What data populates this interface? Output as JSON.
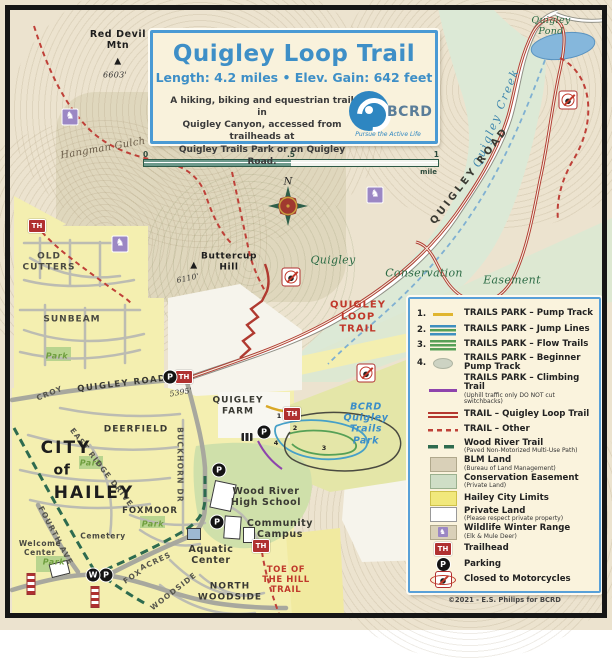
{
  "title_box": {
    "title": "Quigley Loop Trail",
    "stats": "Length: 4.2 miles  •  Elev. Gain: 642 feet",
    "description": "A hiking, biking and equestrian trail in\nQuigley Canyon, accessed from trailheads at\nQuigley Trails Park or on Quigley Road.",
    "logo": {
      "name": "BCRD",
      "tagline": "Pursue the Active Life"
    }
  },
  "scale_bar": {
    "tick0": "0",
    "tick_half": ".5",
    "tick1": "1",
    "unit": "mile"
  },
  "compass": {
    "north": "N"
  },
  "labels": {
    "red_devil_mtn": "Red Devil\nMtn",
    "red_devil_elev": "6603'",
    "triangle": "▲",
    "quigley_pond": "Quigley\nPond",
    "quigley_creek": "Quigley Creek",
    "hangman_gulch": "Hangman Gulch",
    "quigley_road": "QUIGLEY ROAD",
    "old_cutters": "OLD\nCUTTERS",
    "sunbeam": "SUNBEAM",
    "park": "Park",
    "buttercup_hill": "Buttercup\nHill",
    "buttercup_elev": "6110'",
    "cons_quigley": "Quigley",
    "cons_conservation": "Conservation",
    "cons_easement": "Easement",
    "quigley_loop_trail": "QUIGLEY\nLOOP\nTRAIL",
    "croy": "CROY",
    "trailhead_elev": "5395'",
    "quigley_farm": "QUIGLEY\nFARM",
    "bcrd_park": "BCRD\nQuigley\nTrails\nPark",
    "deerfield": "DEERFIELD",
    "east_ridge_drive": "EAST RIDGE DRIVE",
    "buckhorn_dr": "BUCKHORN DR",
    "city": "CITY",
    "of": "of",
    "hailey": "HAILEY",
    "foxmoor": "FOXMOOR",
    "cemetery": "Cemetery",
    "welcome_center": "Welcome\nCenter",
    "fourth_ave": "FOURTH AVE",
    "wood_river_hs": "Wood River\nHigh School",
    "community_campus": "Community\nCampus",
    "aquatic_center": "Aquatic\nCenter",
    "north_woodside": "NORTH\nWOODSIDE",
    "toe_of_the_hill": "TOE OF\nTHE HILL\nTRAIL",
    "fox": "FOX",
    "acres": "ACRES",
    "woodside": "WOODSIDE"
  },
  "icons": {
    "trailhead": "TH",
    "parking": "P",
    "welcome": "W",
    "deer": "♞"
  },
  "trail_markers": {
    "m1": "1",
    "m2": "2",
    "m3": "3",
    "m4": "4"
  },
  "legend": {
    "items": [
      {
        "num": "1.",
        "label": "TRAILS PARK – Pump Track"
      },
      {
        "num": "2.",
        "label": "TRAILS PARK – Jump Lines"
      },
      {
        "num": "3.",
        "label": "TRAILS PARK – Flow Trails"
      },
      {
        "num": "4.",
        "label": "TRAILS PARK – Beginner\nPump Track"
      },
      {
        "label": "TRAILS PARK – Climbing Trail",
        "sub": "(Uphill traffic only DO NOT cut switchbacks)"
      },
      {
        "label": "TRAIL – Quigley Loop Trail"
      },
      {
        "label": "TRAIL – Other"
      },
      {
        "label": "Wood River Trail",
        "sub": "(Paved Non-Motorized Multi-Use Path)"
      },
      {
        "label": "BLM Land",
        "sub": "(Bureau of Land Management)"
      },
      {
        "label": "Conservation Easement",
        "sub": "(Private Land)"
      },
      {
        "label": "Hailey City Limits"
      },
      {
        "label": "Private Land",
        "sub": "(Please respect private property)"
      },
      {
        "label": "Wildlife Winter Range",
        "sub": "(Elk & Mule Deer)"
      },
      {
        "label": "Trailhead"
      },
      {
        "label": "Parking"
      },
      {
        "label": "Closed to Motorcycles"
      }
    ],
    "credit": "©2021 - E.S. Philips for BCRD"
  }
}
